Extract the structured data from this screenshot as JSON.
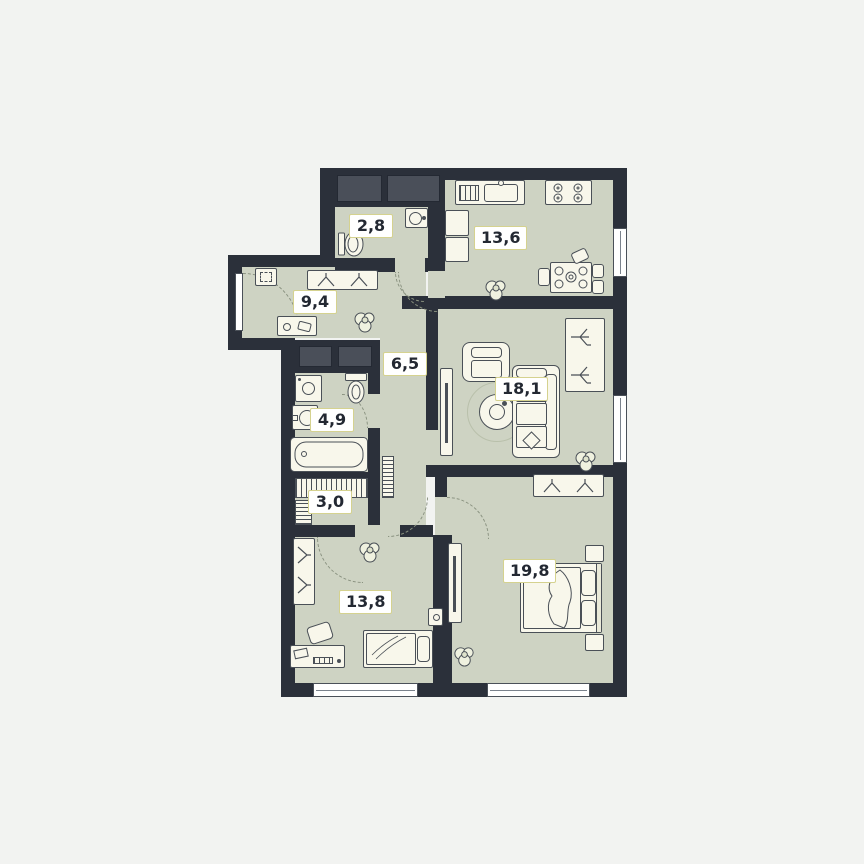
{
  "page": {
    "background": "#f2f3f1",
    "kind": "apartment-floor-plan"
  },
  "colors": {
    "wall": "#2b303a",
    "room_fill": "#ced3c3",
    "furniture_fill": "#f8f7eb",
    "furniture_stroke": "#4a5057",
    "shaft_fill": "#4a4f59",
    "label_border": "#d5d28f",
    "label_text": "#232832",
    "window_frame": "#4a5058",
    "door_arc": "#8a9280"
  },
  "rooms": [
    {
      "id": "wc",
      "area_label": "2,8",
      "furniture": [
        "hand-sink",
        "toilet"
      ]
    },
    {
      "id": "kitchen",
      "area_label": "13,6",
      "furniture": [
        "kitchen-sink",
        "stove",
        "fridge",
        "dining-table",
        "chairs",
        "plant"
      ]
    },
    {
      "id": "hallway",
      "area_label": "9,4",
      "furniture": [
        "electrical-panel",
        "wardrobe-hangers",
        "bench",
        "plant",
        "entrance-door"
      ]
    },
    {
      "id": "corridor",
      "area_label": "6,5",
      "furniture": [
        "radiator"
      ]
    },
    {
      "id": "bathroom",
      "area_label": "4,9",
      "furniture": [
        "washing-machine",
        "toilet",
        "sink",
        "bathtub"
      ]
    },
    {
      "id": "storage",
      "area_label": "3,0",
      "furniture": [
        "shelving"
      ]
    },
    {
      "id": "living-room",
      "area_label": "18,1",
      "furniture": [
        "tv-stand",
        "armchair",
        "sofa",
        "coffee-table",
        "rug",
        "wardrobe-hangers",
        "plant"
      ]
    },
    {
      "id": "bedroom-main",
      "area_label": "19,8",
      "furniture": [
        "wardrobe-hangers",
        "double-bed",
        "nightstands",
        "dresser",
        "plant"
      ]
    },
    {
      "id": "bedroom-second",
      "area_label": "13,8",
      "furniture": [
        "wardrobe-hangers",
        "single-bed",
        "nightstand",
        "desk",
        "chair",
        "plant"
      ]
    }
  ]
}
